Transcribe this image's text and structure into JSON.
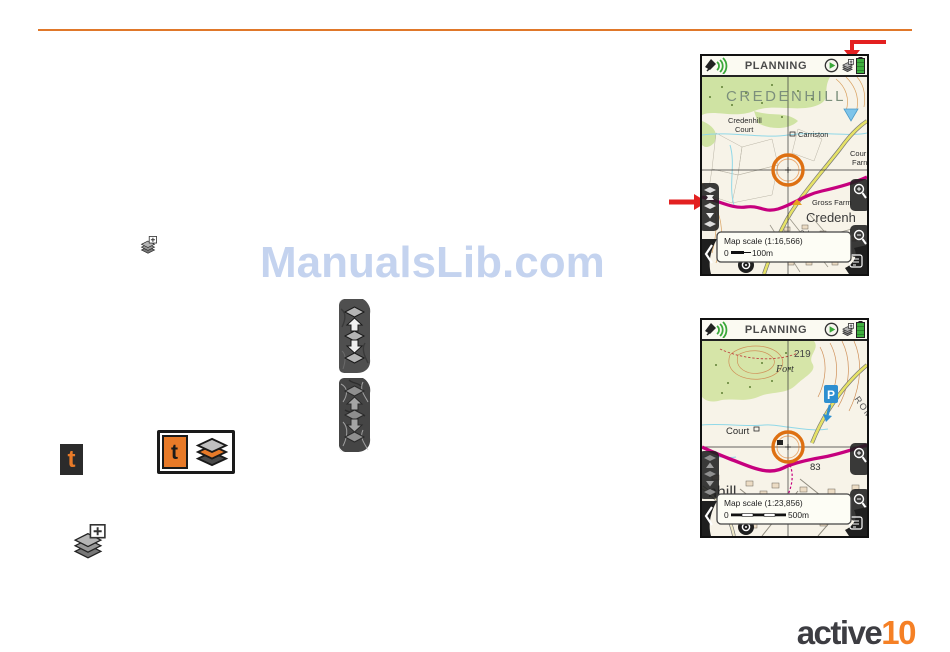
{
  "page": {
    "watermark": "ManualsLib.com",
    "logo_word": "active",
    "logo_number": "10"
  },
  "inline": {
    "t_small": "t",
    "t_boxed": "t"
  },
  "screen1": {
    "title": "PLANNING",
    "scale_label": "Map scale (1:16,566)",
    "scale_zero": "0",
    "scale_end": "100m",
    "labels": {
      "hill": "CREDENHILL",
      "cred1": "Credenhill",
      "cred2": "Court",
      "carriston": "Carriston",
      "cf1": "Cour",
      "cf2": "Farn",
      "gross": "Gross Farm",
      "big": "Credenh",
      "sch": "Sch"
    }
  },
  "screen2": {
    "title": "PLANNING",
    "scale_label": "Map scale (1:23,856)",
    "scale_zero": "0",
    "scale_end": "500m",
    "labels": {
      "height": "219",
      "fort": "Fort",
      "court": "Court",
      "roman": "ROMAN",
      "n83": "83",
      "nhill": "nhill",
      "parking": "P"
    }
  },
  "colors": {
    "accent_orange": "#e0782a",
    "logo_orange": "#f58025",
    "arrow_red": "#e32020",
    "watermark_blue": "#c4d3ef",
    "route_magenta": "#c6007e",
    "circle_orange": "#de7012",
    "battery_green": "#3fae3f",
    "woodland_green": "#cfe3a3",
    "parking_blue": "#2e8fd0"
  }
}
